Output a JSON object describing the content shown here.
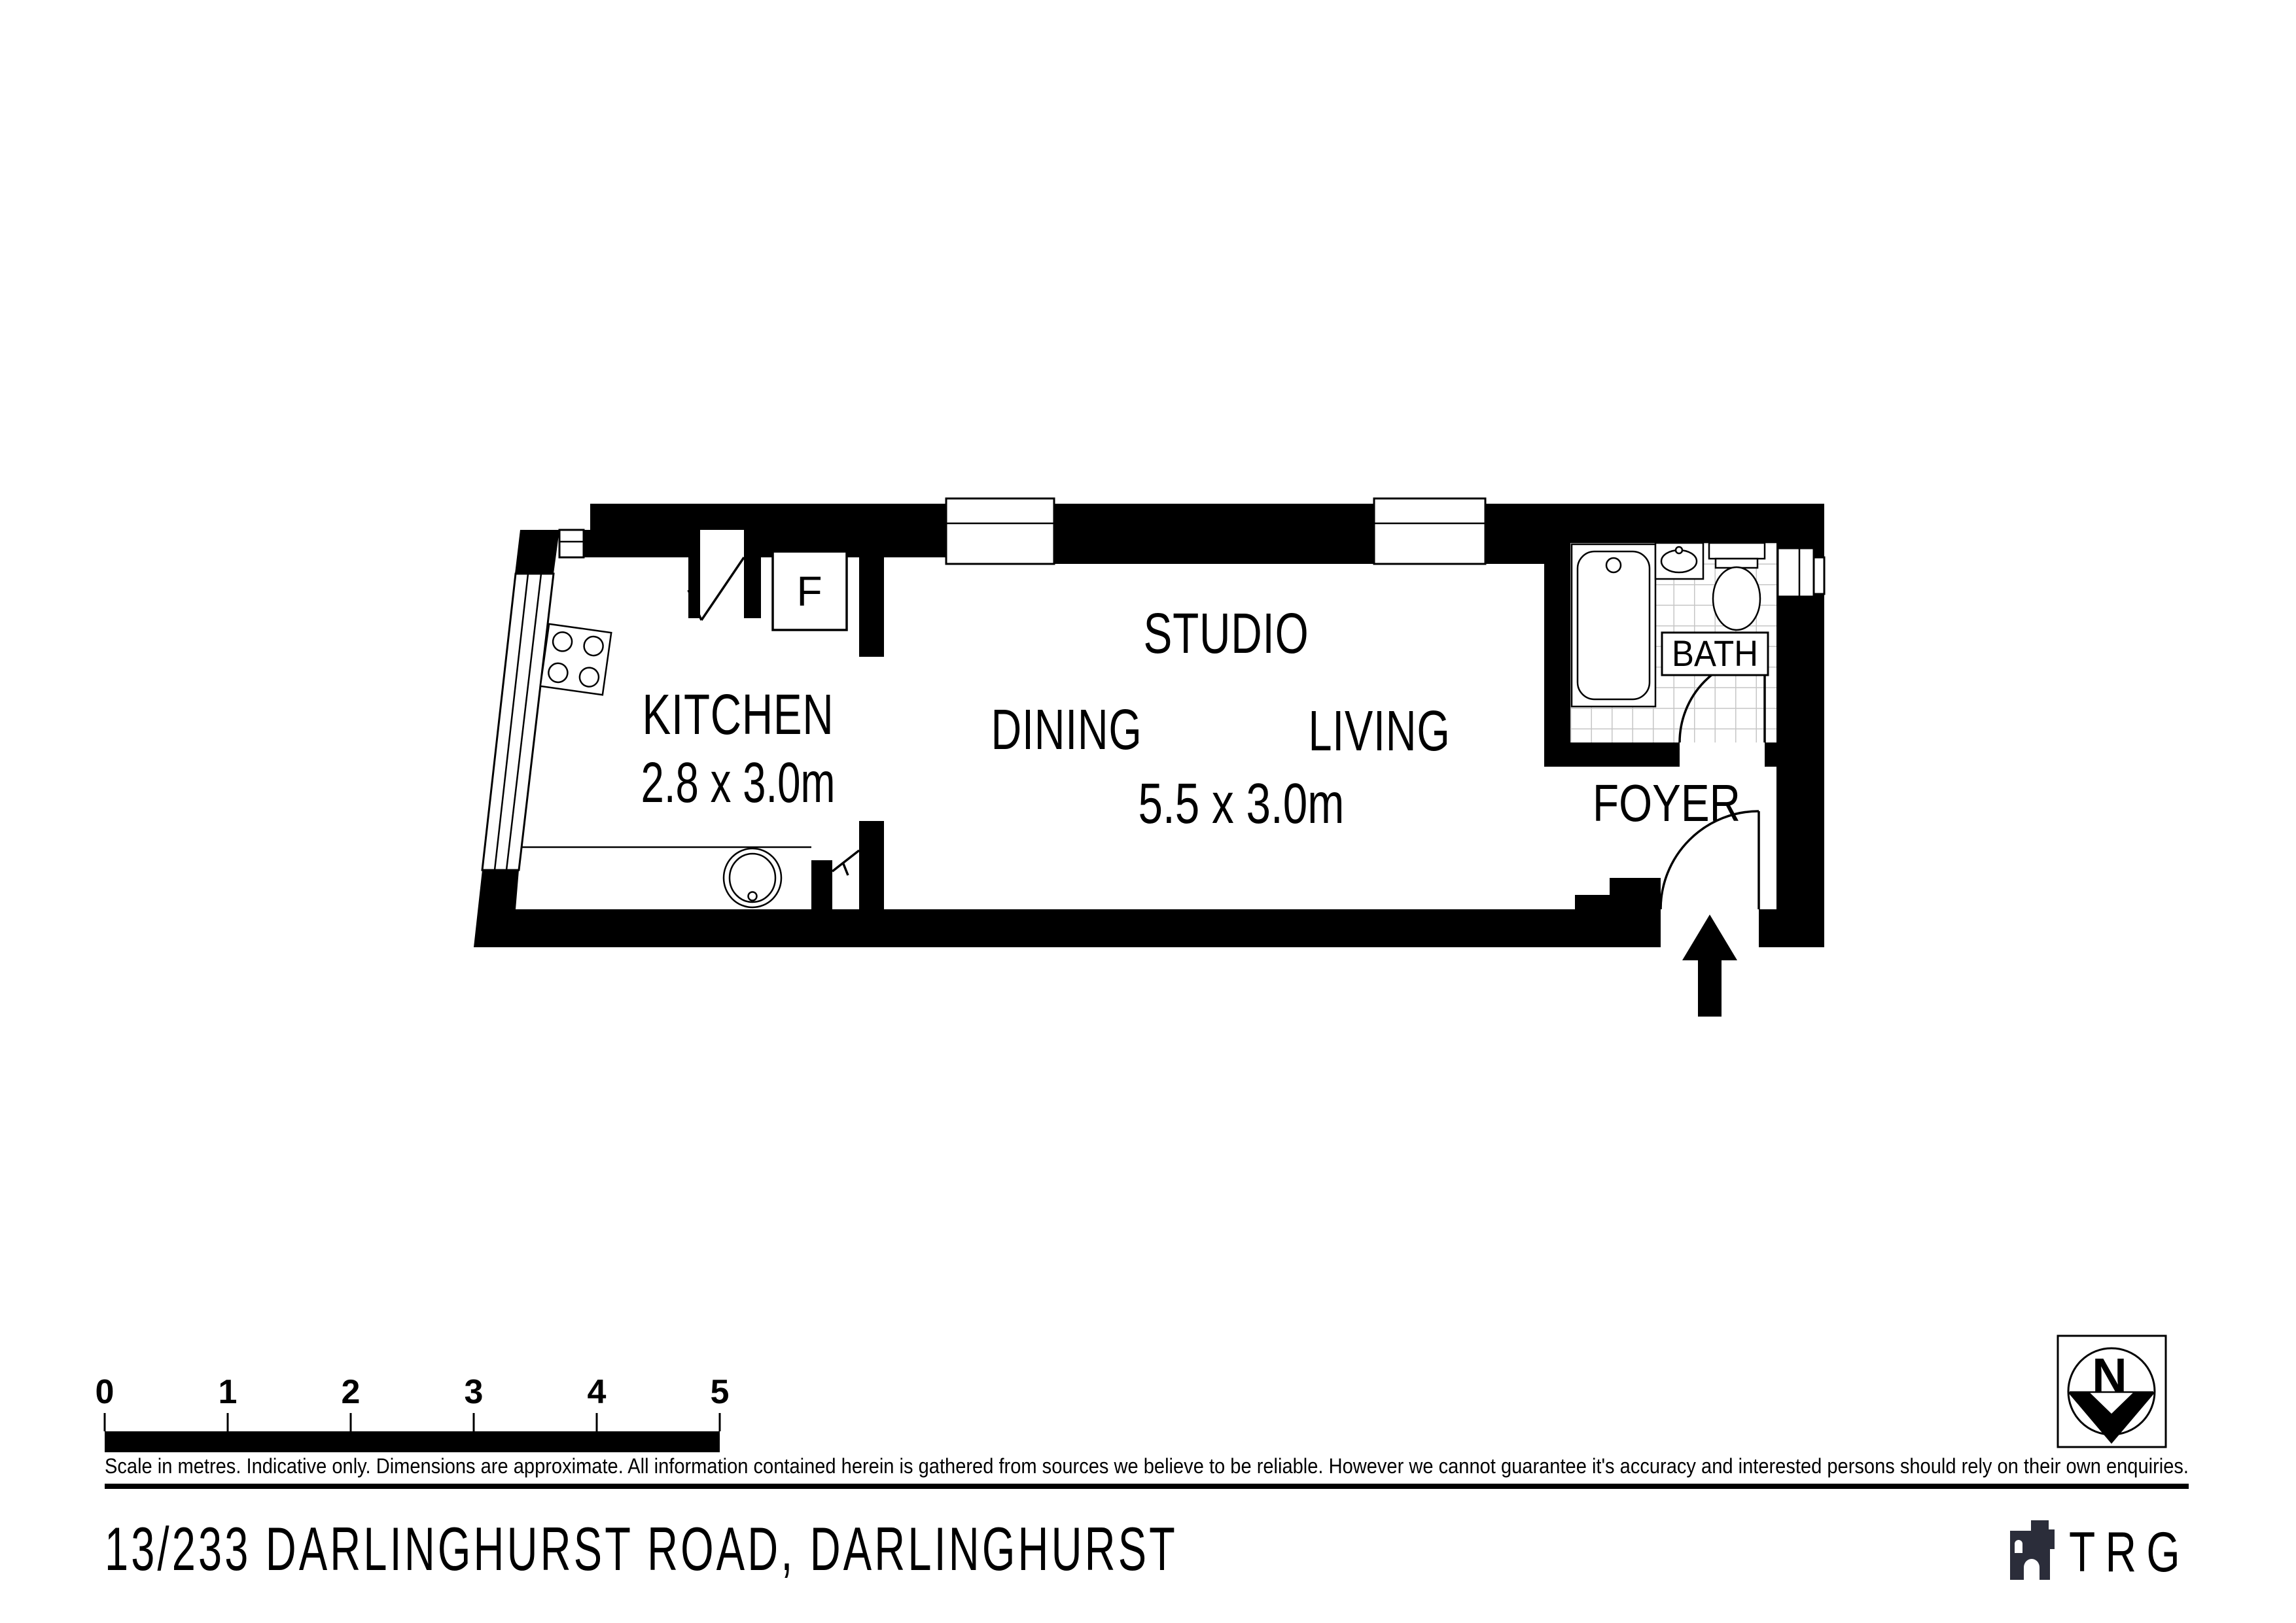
{
  "title": "Floor plan",
  "plan": {
    "rooms": {
      "kitchen": {
        "label": "KITCHEN",
        "dimensions": "2.8 x 3.0m"
      },
      "studio": {
        "label": "STUDIO",
        "dimensions": "5.5 x 3.0m",
        "zones": {
          "dining": "DINING",
          "living": "LIVING"
        }
      },
      "bath": {
        "label": "BATH"
      },
      "foyer": {
        "label": "FOYER"
      },
      "fridge": {
        "label": "F"
      }
    }
  },
  "scale_bar": {
    "tick_labels": [
      "0",
      "1",
      "2",
      "3",
      "4",
      "5"
    ],
    "caption": "Scale in metres. Indicative only. Dimensions are approximate. All information contained herein is gathered from sources we believe to be reliable. However we cannot guarantee it's accuracy and interested persons should rely on their own enquiries."
  },
  "footer": {
    "address": "13/233 DARLINGHURST ROAD, DARLINGHURST",
    "brand": "TRG"
  },
  "compass": {
    "north_label": "N"
  },
  "colors": {
    "wall": "#000000",
    "tile_line": "#c6c6c6",
    "brand": "#2b2d3a",
    "text": "#000000"
  }
}
